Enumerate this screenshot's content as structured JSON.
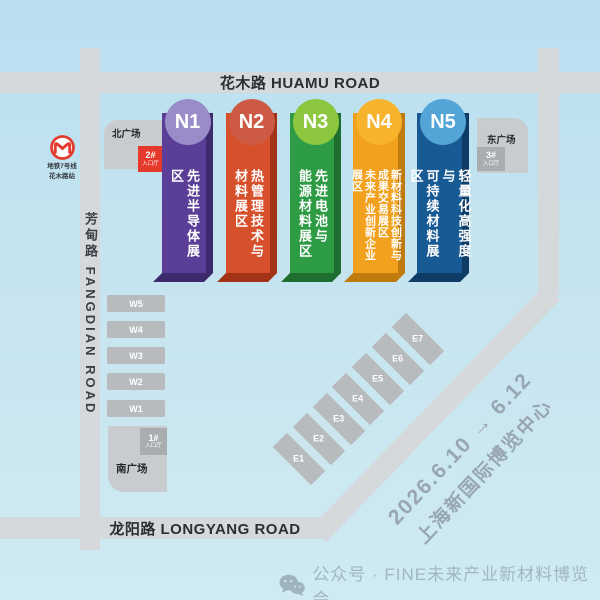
{
  "roads": {
    "huamu": "花木路 HUAMU ROAD",
    "fangdian": "芳甸路 FANGDIAN ROAD",
    "longyang": "龙阳路 LONGYANG ROAD"
  },
  "metro": {
    "line": "地铁7号线",
    "station": "花木路站",
    "color": "#e23b2e"
  },
  "plazas": {
    "north": {
      "label": "北广场",
      "entrance_no": "2#",
      "entrance_label": "入口厅",
      "badge_color": "#e5392b"
    },
    "east": {
      "label": "东广场",
      "entrance_no": "3#",
      "entrance_label": "入口厅",
      "badge_color": "#a9adb0"
    },
    "south": {
      "label": "南广场",
      "entrance_no": "1#",
      "entrance_label": "入口厅",
      "badge_color": "#a9adb0"
    }
  },
  "north_halls": [
    {
      "id": "N1",
      "name": "先进半导体展区",
      "color": "#5b3e97",
      "circle": "#9a8cc8",
      "dark": "#3d2a6d"
    },
    {
      "id": "N2",
      "name": "热管理技术与\n材料展区",
      "color": "#d7502c",
      "circle": "#cc5a45",
      "dark": "#a23317"
    },
    {
      "id": "N3",
      "name": "先进电池与\n能源材料展区",
      "color": "#2e9b45",
      "circle": "#8dc63f",
      "dark": "#1e6f2f"
    },
    {
      "id": "N4",
      "name": "新材料科技创新与\n成果交易展区\n未来产业创新企业展区",
      "color": "#f2a11e",
      "circle": "#f7b32b",
      "dark": "#c07b0e"
    },
    {
      "id": "N5",
      "name": "轻量化高强度与\n可持续材料展区",
      "color": "#185a94",
      "circle": "#53a4d7",
      "dark": "#0f3c67"
    }
  ],
  "west_halls": [
    "W5",
    "W4",
    "W3",
    "W2",
    "W1"
  ],
  "east_halls": [
    "E1",
    "E2",
    "E3",
    "E4",
    "E5",
    "E6",
    "E7"
  ],
  "event": {
    "dates": "2026.6.10 → 6.12",
    "venue": "上海新国际博览中心"
  },
  "footer": {
    "label": "公众号 · FINE未来产业新材料博览会"
  }
}
